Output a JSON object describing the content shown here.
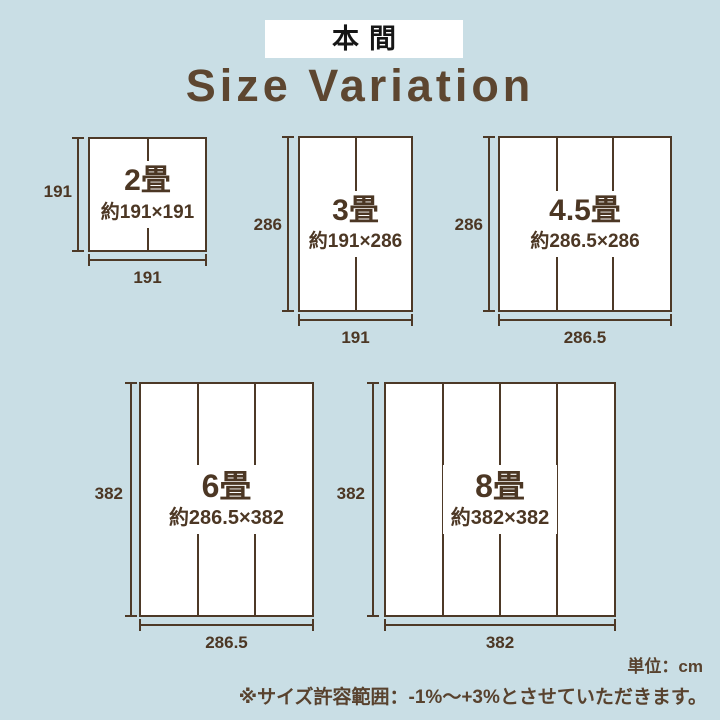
{
  "header": {
    "brand": "本間"
  },
  "title": "Size Variation",
  "diagrams": [
    {
      "name": "2畳",
      "size": "約191×191",
      "height_label": "191",
      "width_label": "191",
      "panels": 2
    },
    {
      "name": "3畳",
      "size": "約191×286",
      "height_label": "286",
      "width_label": "191",
      "panels": 2
    },
    {
      "name": "4.5畳",
      "size": "約286.5×286",
      "height_label": "286",
      "width_label": "286.5",
      "panels": 3
    },
    {
      "name": "6畳",
      "size": "約286.5×382",
      "height_label": "382",
      "width_label": "286.5",
      "panels": 3
    },
    {
      "name": "8畳",
      "size": "約382×382",
      "height_label": "382",
      "width_label": "382",
      "panels": 4
    }
  ],
  "footer": {
    "unit": "単位：cm",
    "note": "※サイズ許容範囲：-1%〜+3%とさせていただきます。"
  },
  "colors": {
    "background": "#c9dee5",
    "line": "#4d3927",
    "text": "#4c3724",
    "title": "#5d4630",
    "note": "#58422e",
    "badge_background": "#ffffff"
  }
}
